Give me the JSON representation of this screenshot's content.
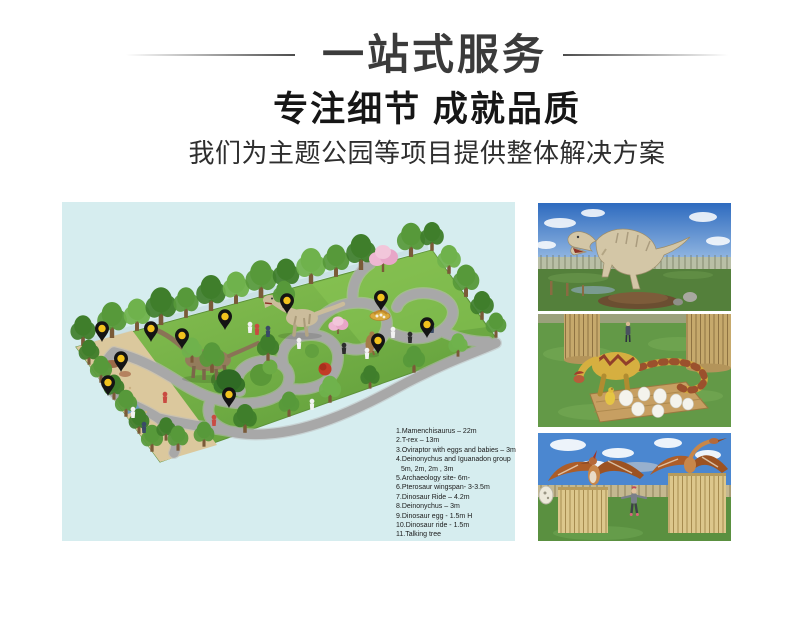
{
  "header": {
    "title": "一站式服务",
    "subtitle": "专注细节 成就品质",
    "tagline": "我们为主题公园等项目提供整体解决方案"
  },
  "map_panel": {
    "legend": {
      "lines": [
        "1.Mamenchisaurus – 22m",
        "2.T-rex – 13m",
        "3.Oviraptor with eggs and babies – 3m",
        "4.Deinonychus and Iguanadon group",
        "5m, 2m, 2m , 3m",
        "5.Archaeology site- 6m-",
        "6.Pterosaur  wingspan- 3-3.5m",
        "7.Dinosaur Ride – 4.2m",
        "8.Deinonychus – 3m",
        "9.Dinosaur egg - 1.5m H",
        "10.Dinosaur ride -  1.5m",
        "11.Talking tree"
      ]
    },
    "icons": {
      "map_pin": {
        "name": "map-pin-icon",
        "count": 11,
        "body_color": "#141414",
        "dot_color": "#f2c21d"
      }
    }
  },
  "colors": {
    "page_background": "#ffffff",
    "panel_background": "#d6edef",
    "heading_text": "#3b3b3b",
    "subheading_text": "#161616",
    "tagline_text": "#2e2e2e",
    "legend_text": "#1b1b1b",
    "grass_green": "#74b046",
    "path_gray": "#a8a8a8",
    "sand_tan": "#dbc89d",
    "sky_blue": "#4b87d0",
    "pin_black": "#141414",
    "pin_yellow": "#f2c21d"
  }
}
